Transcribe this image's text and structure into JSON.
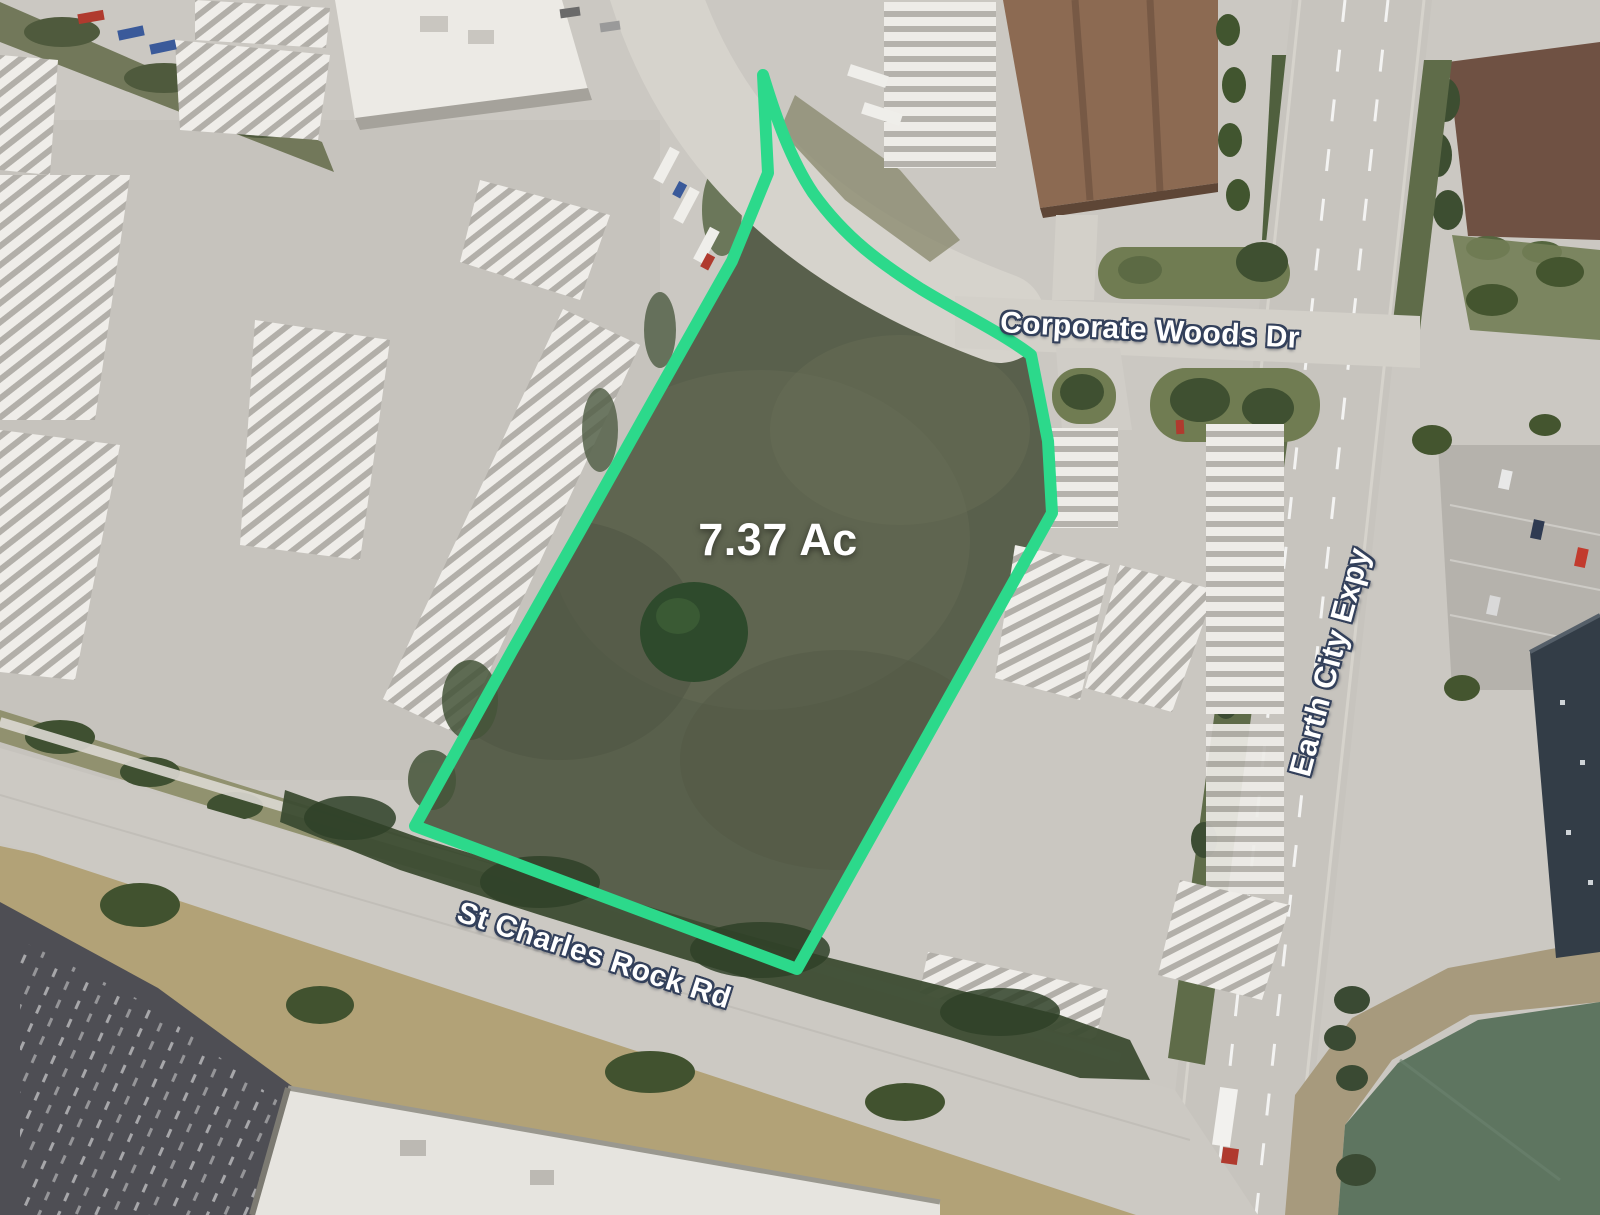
{
  "map": {
    "type": "aerial-satellite-imagery",
    "parcel": {
      "area_label": "7.37 Ac",
      "outline_color": "#2cd98b"
    },
    "road_labels": [
      {
        "id": "corporate-woods-dr",
        "text": "Corporate Woods Dr"
      },
      {
        "id": "earth-city-expy",
        "text": "Earth City Expy"
      },
      {
        "id": "st-charles-rock-rd",
        "text": "St Charles Rock Rd"
      }
    ],
    "label_style": {
      "text_color": "#ffffff",
      "halo_color": "#33405b"
    },
    "terrain_colors": {
      "pavement": "#cbc8c2",
      "parcel_grass": "#59604c",
      "pond_water": "#5e7560",
      "dry_grass": "#b2a277"
    }
  }
}
